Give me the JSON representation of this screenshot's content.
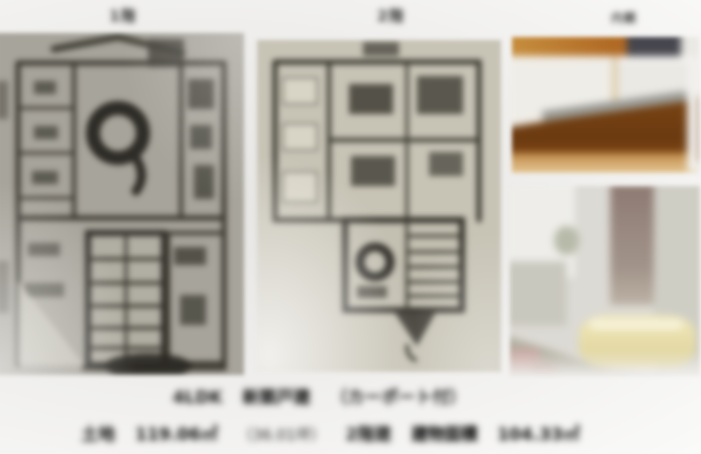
{
  "labels": {
    "floor1": "1階",
    "floor2": "2階",
    "interior": "内観"
  },
  "caption": {
    "line1": {
      "type": "4LDK",
      "highlight": "新築戸建",
      "note": "（カーポート付）"
    },
    "line2": {
      "land_label": "土地",
      "land_area": "119.06㎡",
      "land_tsubo": "（36.01坪）",
      "structure": "2階建",
      "building_label": "建物面積",
      "building_area": "104.33㎡"
    }
  },
  "panels": {
    "floor_plan_1f": "1階間取り図",
    "floor_plan_2f": "2階間取り図",
    "photo_top": "キッチン内観写真",
    "photo_bottom": "浴室内観写真"
  },
  "colors": {
    "plan1_paper": "#a7a49b",
    "plan2_paper": "#c7c3b5",
    "plan_line": "#3a382f",
    "kitchen_wood": "#8a4d16",
    "bath_tub": "#e8dfae",
    "caption_text": "#191919"
  }
}
